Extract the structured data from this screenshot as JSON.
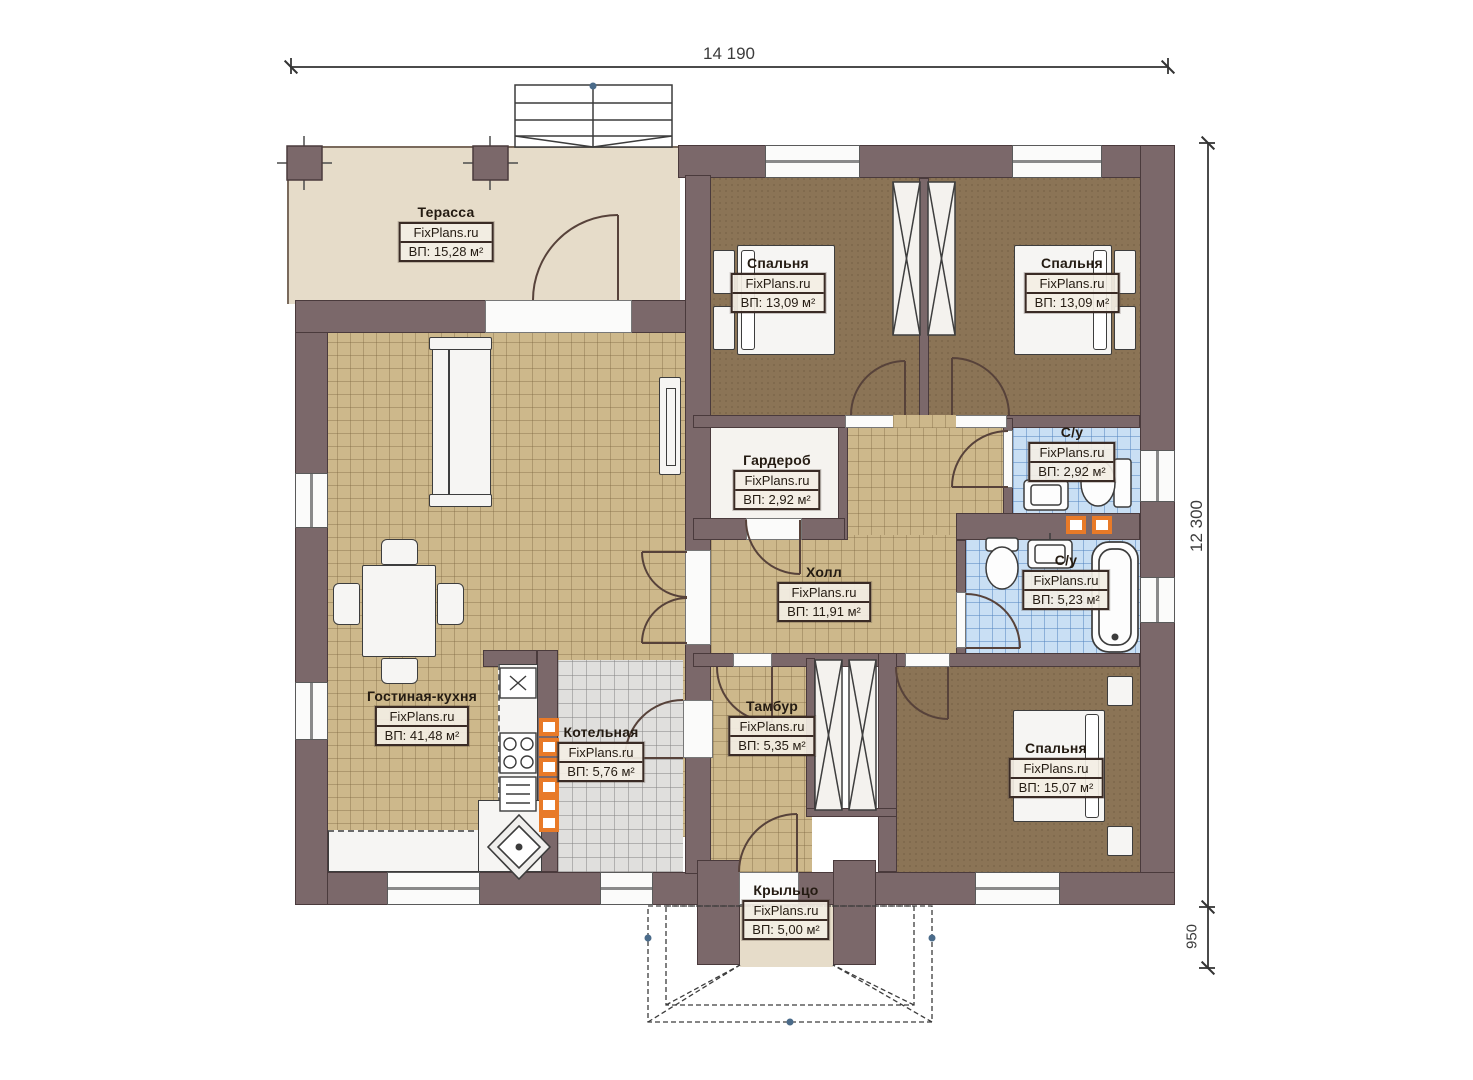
{
  "watermark": "FixPlans.ru",
  "dimensions": {
    "top_width": "14 190",
    "right_height": "12 300",
    "porch_depth": "950"
  },
  "rooms": {
    "terrace": {
      "name": "Терасса",
      "area": "ВП: 15,28 м²"
    },
    "bedroom1": {
      "name": "Спальня",
      "area": "ВП: 13,09 м²"
    },
    "bedroom2": {
      "name": "Спальня",
      "area": "ВП: 13,09 м²"
    },
    "wardrobe": {
      "name": "Гардероб",
      "area": "ВП: 2,92 м²"
    },
    "bath1": {
      "name": "С/у",
      "area": "ВП: 2,92 м²"
    },
    "bath2": {
      "name": "С/у",
      "area": "ВП: 5,23 м²"
    },
    "hall": {
      "name": "Холл",
      "area": "ВП: 11,91 м²"
    },
    "living": {
      "name": "Гостиная-кухня",
      "area": "ВП: 41,48 м²"
    },
    "boiler": {
      "name": "Котельная",
      "area": "ВП: 5,76 м²"
    },
    "tambour": {
      "name": "Тамбур",
      "area": "ВП: 5,35 м²"
    },
    "bedroom3": {
      "name": "Спальня",
      "area": "ВП: 15,07 м²"
    },
    "porch": {
      "name": "Крыльцо",
      "area": "ВП: 5,00 м²"
    }
  },
  "colors": {
    "wall": "#7b686a",
    "floor_tile": "#cdb88b",
    "floor_bedroom": "#8b7456",
    "floor_bath": "#c9dff4",
    "floor_terrace": "#e6dcc9",
    "accent_orange": "#e87a28"
  }
}
